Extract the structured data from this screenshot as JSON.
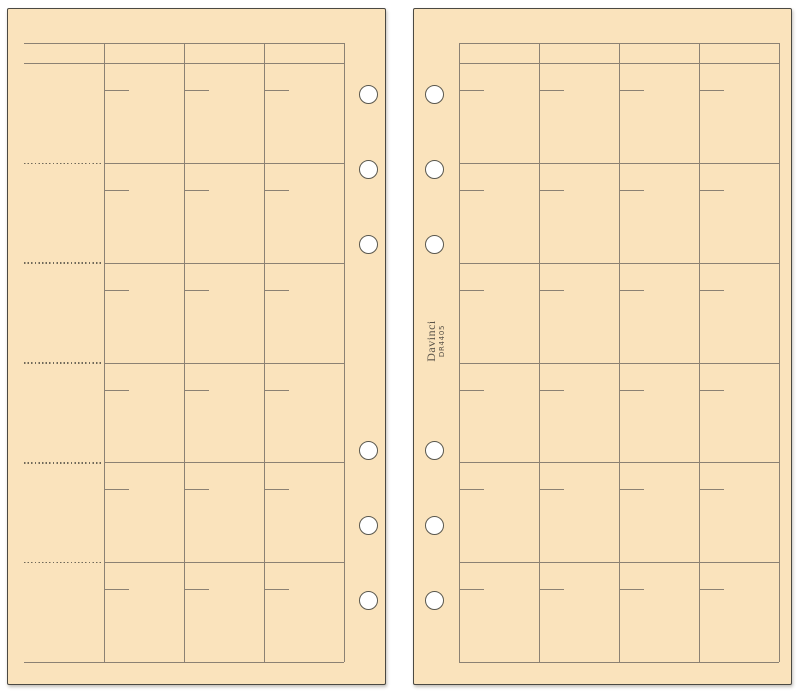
{
  "brand": {
    "name": "Davinci",
    "model": "DR4405"
  },
  "colors": {
    "background": "#ffffff",
    "paper": "#fae3bc",
    "paper_border": "#4b4942",
    "grid_line": "#8b8173",
    "dotted_line": "#6f6859",
    "hole_fill": "#ffffff",
    "hole_border": "#5a584f",
    "brand_ink": "#5c554a"
  },
  "left_page": {
    "rows": 6,
    "columns": 3,
    "has_label_column": true,
    "label_separator_style": "dotted",
    "holes": 6
  },
  "right_page": {
    "rows": 6,
    "columns": 4,
    "has_label_column": false,
    "holes": 6
  },
  "icons": {
    "binder_hole": "punched-hole-circle"
  }
}
